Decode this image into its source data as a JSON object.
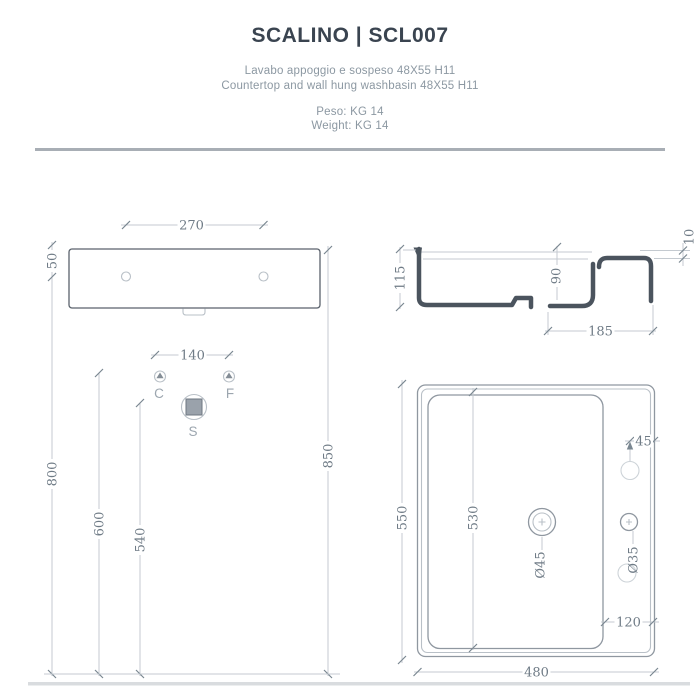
{
  "header": {
    "title": "SCALINO | SCL007",
    "subtitle_it": "Lavabo appoggio e sospeso 48X55  H11",
    "subtitle_en": "Countertop and wall hung washbasin 48X55  H11",
    "weight_it": "Peso: KG 14",
    "weight_en": "Weight: KG 14"
  },
  "views": {
    "back": {
      "width": "270",
      "hole_offset": "50"
    },
    "section": {
      "total_height": "115",
      "bowl_depth": "90",
      "deck_thickness": "10",
      "step_depth": "185"
    },
    "installation": {
      "tap_spacing": "140",
      "fixing_height": "800",
      "supply_height": "600",
      "drain_height": "540",
      "rim_height": "850",
      "cold_label": "C",
      "hot_label": "F",
      "drain_label": "S"
    },
    "plan": {
      "depth": "550",
      "bowl_depth": "530",
      "width": "480",
      "deck_width": "120",
      "hole_inset": "45",
      "drain_diameter": "Ø45",
      "tap_diameter": "Ø35"
    }
  }
}
